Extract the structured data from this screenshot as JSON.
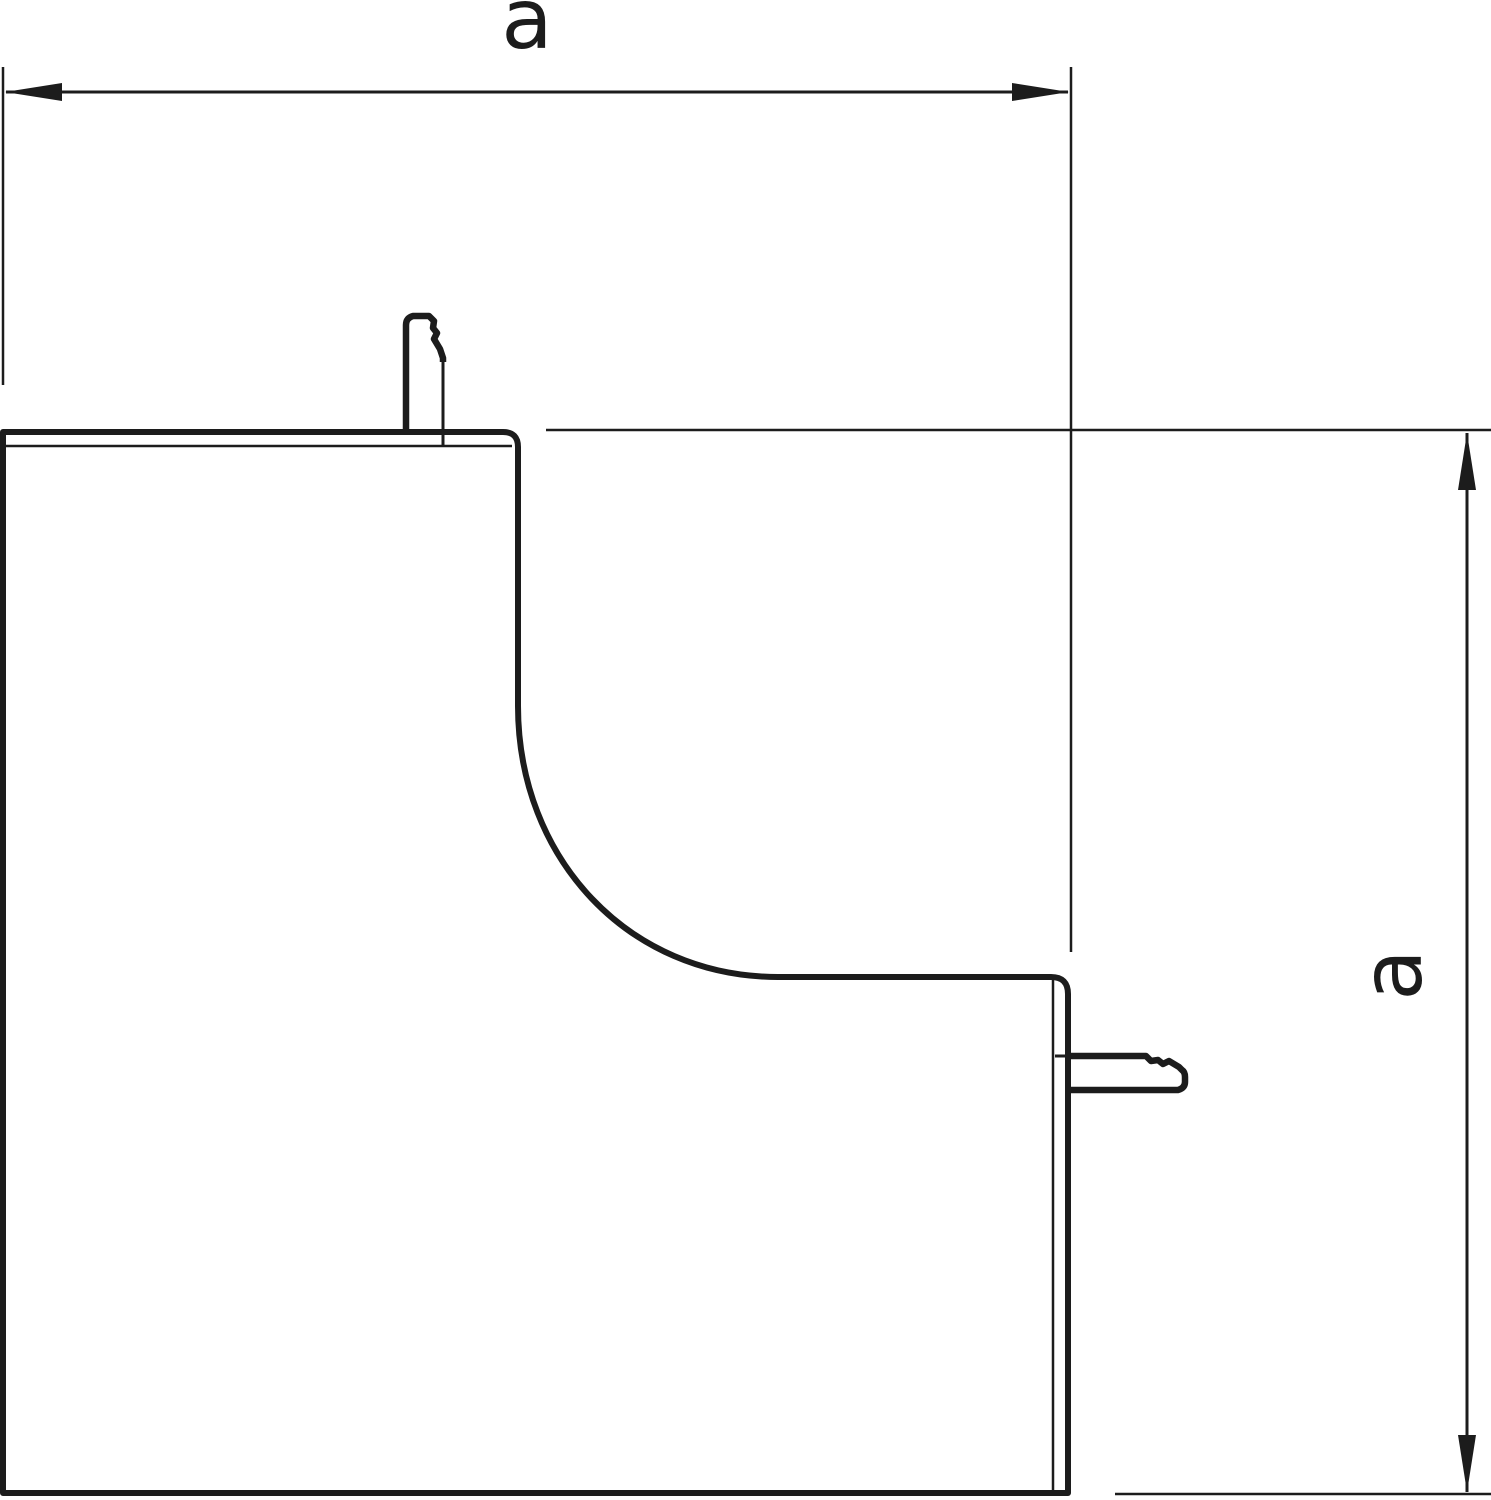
{
  "colors": {
    "line": "#1c1c1c",
    "background": "#ffffff"
  },
  "dimensions": {
    "horizontal": {
      "label": "a"
    },
    "vertical": {
      "label": "a"
    }
  }
}
